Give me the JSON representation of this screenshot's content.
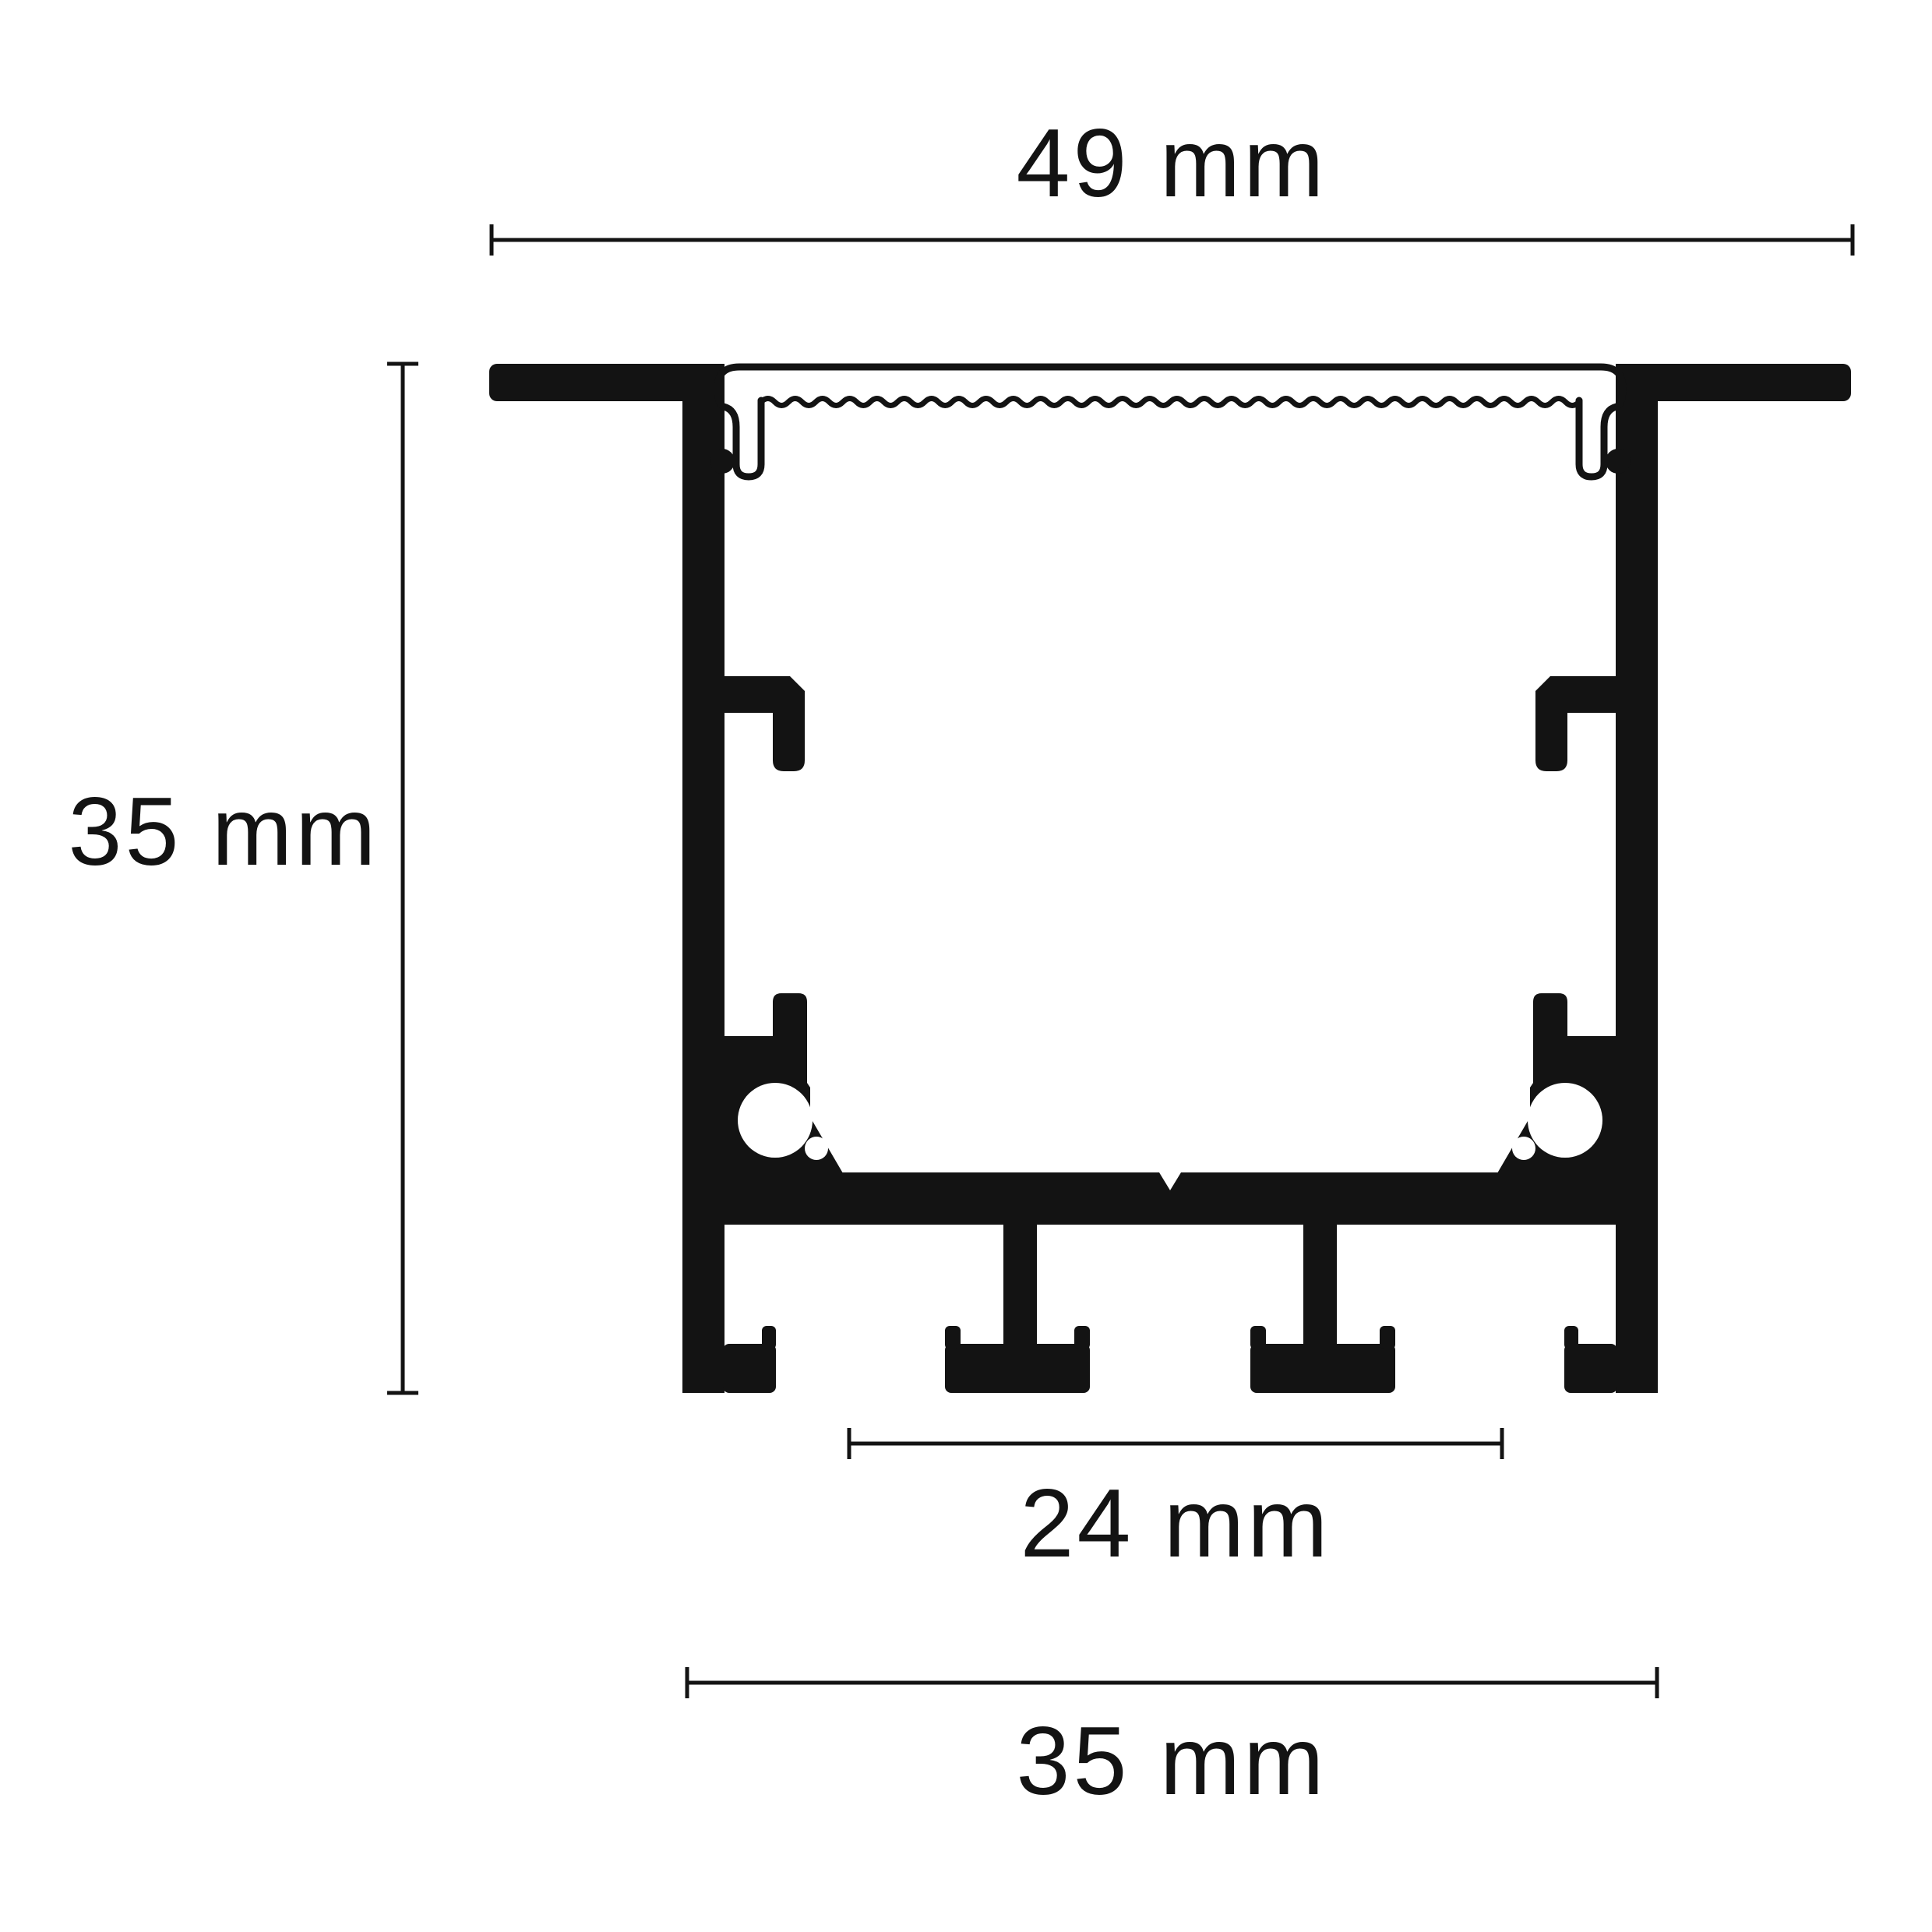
{
  "colors": {
    "ink": "#131313",
    "background": "#ffffff"
  },
  "dimensions": {
    "overall_width": {
      "label": "49 mm"
    },
    "height": {
      "label": "35 mm"
    },
    "led_floor_width": {
      "label": "24 mm"
    },
    "body_width": {
      "label": "35 mm"
    }
  }
}
